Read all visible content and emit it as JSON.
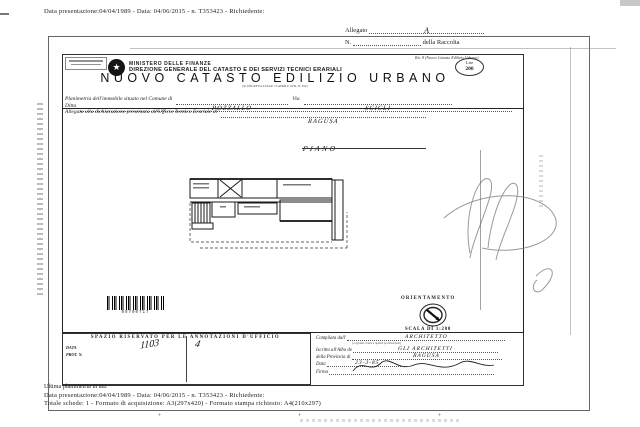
{
  "document": {
    "top_line": "Data presentazione:04/04/1989 - Data: 04/06/2015 - n. T353423 - Richiedente:",
    "allegato_label": "Allegato",
    "allegato_value": "A",
    "raccolta_n_label": "N.",
    "raccolta_label": "della Raccolta"
  },
  "header": {
    "ministry": "MINISTERO DELLE FINANZE",
    "directorate": "DIREZIONE GENERALE DEL CATASTO E DEI SERVIZI TECNICI ERARIALI",
    "model_ref": "Riv. 8 (Nuovo Catasto Edilizio Urbano)",
    "stamp_currency": "Lire",
    "stamp_amount": "200",
    "title": "NUOVO CATASTO EDILIZIO URBANO",
    "law_ref": "(R. DECRETO-LEGGE 13 APRILE 1939, N. 652)"
  },
  "fields": {
    "comune_label": "Planimetria dell'immobile situato nel Comune di",
    "comune_value": "POZZALLO",
    "via_label": "Via",
    "via_value": "SCICLI",
    "ditta_label": "Ditta",
    "ufficio_label": "Allegata alla dichiarazione presentata all'Ufficio Tecnico Erariale di",
    "ufficio_value": "RAGUSA"
  },
  "plan": {
    "piano_label": "PIANO",
    "barcode_number": "09700717",
    "orientation_label": "ORIENTAMENTO",
    "scale_label": "SCALA DI 1:200"
  },
  "annotations": {
    "title": "SPAZIO RISERVATO PER LE ANNOTAZIONI D'UFFICIO",
    "data_label": "DATA",
    "prot_label": "PROT. N.",
    "handwritten_number": "1103",
    "handwritten_mark": "4"
  },
  "compiler": {
    "compilata_label": "Compilata dall'",
    "compilata_value": "ARCHITETTO",
    "compilata_note": "(cognome, nome e qualità professionale)",
    "albo_label": "Iscritto all'Albo de",
    "albo_value": "GLI ARCHITETTI",
    "provincia_label": "della Provincia di",
    "provincia_value": "RAGUSA",
    "data_label": "Data",
    "data_value": "23-3-85",
    "firma_label": "Firma"
  },
  "footer": {
    "line1": "Ultima planimetria in atti",
    "line2": "Data presentazione:04/04/1989 - Data: 04/06/2015 - n. T353423 - Richiedente:",
    "line3": "Totale schede: 1 - Formato di acquisizione: A3(297x420) - Formato stampa richiesto: A4(210x297)"
  }
}
